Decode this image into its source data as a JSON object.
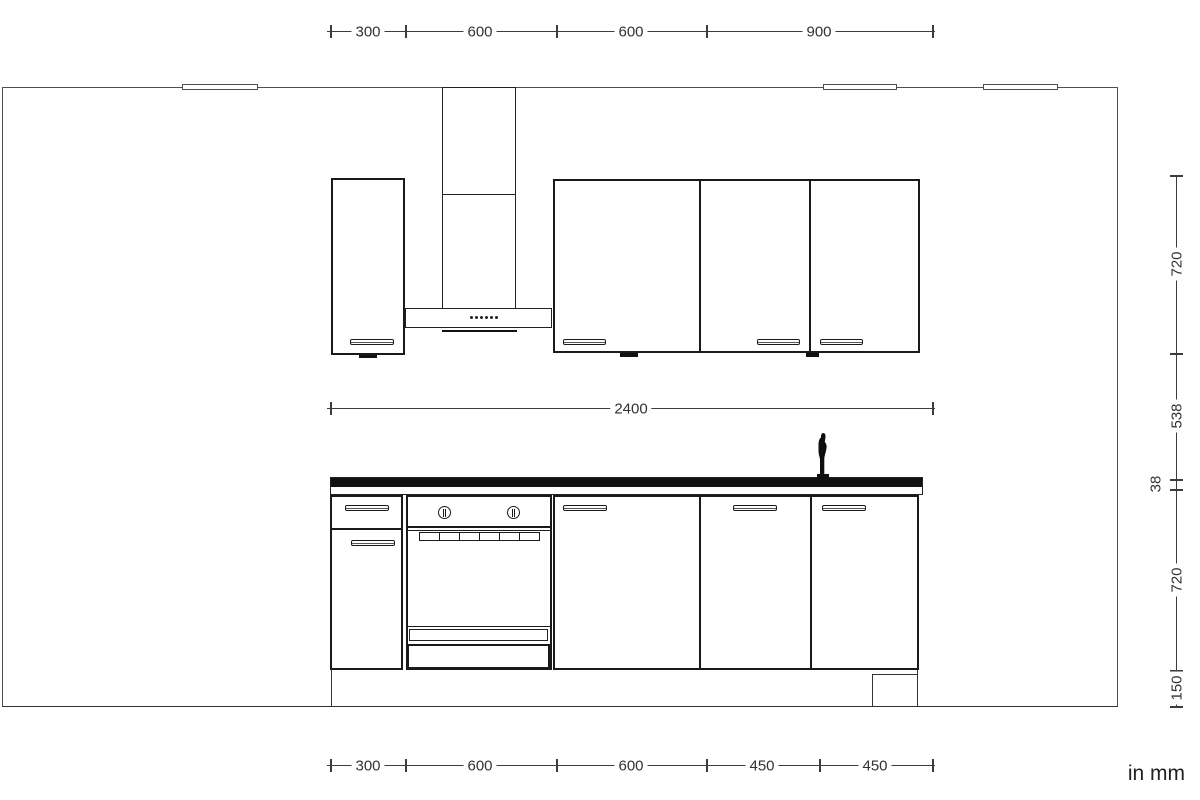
{
  "unit_label": "in mm",
  "dimensions": {
    "top": {
      "segments": [
        "300",
        "600",
        "600",
        "900"
      ]
    },
    "middle": {
      "total": "2400"
    },
    "bottom": {
      "segments": [
        "300",
        "600",
        "600",
        "450",
        "450"
      ]
    },
    "right": {
      "segments": [
        "720",
        "538",
        "38",
        "720",
        "150"
      ]
    }
  },
  "colors": {
    "background": "#ffffff",
    "cabinet_outline": "#1a1a1a",
    "wall_line": "#4f4f4f",
    "dimension_line": "#3d3d3d",
    "dimension_text": "#323232",
    "countertop_fill": "#111111"
  },
  "icons": {
    "faucet": "faucet-icon",
    "hood_controls": "hood-control-dots-icon",
    "oven_knob": "oven-knob-icon"
  }
}
